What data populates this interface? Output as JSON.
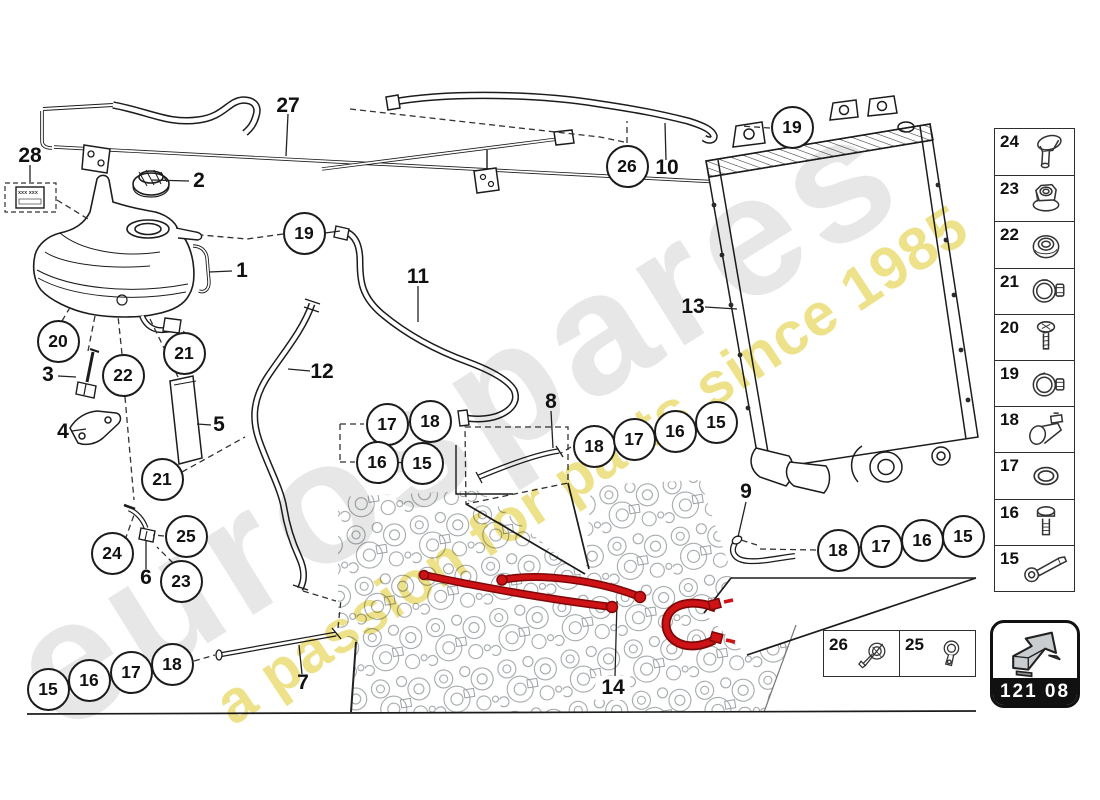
{
  "watermark": {
    "brand": "eurospares",
    "tagline": "a passion for parts since 1985",
    "brand_color": "#e7e7e7",
    "tagline_color": "#ece083"
  },
  "diagram": {
    "highlight_color": "#ce1216",
    "plate_text": "xxx xxx",
    "callouts": [
      {
        "label": "19",
        "x": 792,
        "y": 127
      },
      {
        "label": "26",
        "x": 627,
        "y": 166
      },
      {
        "label": "19",
        "x": 304,
        "y": 233
      },
      {
        "label": "20",
        "x": 58,
        "y": 341
      },
      {
        "label": "21",
        "x": 184,
        "y": 353
      },
      {
        "label": "22",
        "x": 123,
        "y": 375
      },
      {
        "label": "21",
        "x": 162,
        "y": 479
      },
      {
        "label": "17",
        "x": 387,
        "y": 424
      },
      {
        "label": "18",
        "x": 430,
        "y": 421
      },
      {
        "label": "16",
        "x": 377,
        "y": 462
      },
      {
        "label": "15",
        "x": 422,
        "y": 463
      },
      {
        "label": "18",
        "x": 594,
        "y": 446
      },
      {
        "label": "17",
        "x": 634,
        "y": 439
      },
      {
        "label": "16",
        "x": 675,
        "y": 431
      },
      {
        "label": "15",
        "x": 716,
        "y": 422
      },
      {
        "label": "18",
        "x": 838,
        "y": 550
      },
      {
        "label": "17",
        "x": 881,
        "y": 546
      },
      {
        "label": "16",
        "x": 922,
        "y": 540
      },
      {
        "label": "15",
        "x": 963,
        "y": 536
      },
      {
        "label": "24",
        "x": 112,
        "y": 553
      },
      {
        "label": "25",
        "x": 186,
        "y": 536
      },
      {
        "label": "23",
        "x": 181,
        "y": 581
      },
      {
        "label": "15",
        "x": 48,
        "y": 689
      },
      {
        "label": "16",
        "x": 89,
        "y": 680
      },
      {
        "label": "17",
        "x": 131,
        "y": 672
      },
      {
        "label": "18",
        "x": 172,
        "y": 664
      }
    ],
    "labels": [
      {
        "text": "27",
        "x": 288,
        "y": 106,
        "boxed": false
      },
      {
        "text": "28",
        "x": 30,
        "y": 156,
        "boxed": false
      },
      {
        "text": "2",
        "x": 199,
        "y": 181,
        "boxed": false
      },
      {
        "text": "1",
        "x": 242,
        "y": 271,
        "boxed": false
      },
      {
        "text": "10",
        "x": 667,
        "y": 168,
        "boxed": false
      },
      {
        "text": "11",
        "x": 418,
        "y": 277,
        "boxed": false
      },
      {
        "text": "13",
        "x": 693,
        "y": 307,
        "boxed": false
      },
      {
        "text": "3",
        "x": 48,
        "y": 375,
        "boxed": false
      },
      {
        "text": "4",
        "x": 63,
        "y": 432,
        "boxed": false
      },
      {
        "text": "5",
        "x": 219,
        "y": 425,
        "boxed": false
      },
      {
        "text": "12",
        "x": 322,
        "y": 372,
        "boxed": false
      },
      {
        "text": "8",
        "x": 551,
        "y": 402,
        "boxed": false
      },
      {
        "text": "9",
        "x": 746,
        "y": 492,
        "boxed": false
      },
      {
        "text": "6",
        "x": 146,
        "y": 578,
        "boxed": false
      },
      {
        "text": "7",
        "x": 303,
        "y": 683,
        "boxed": false
      },
      {
        "text": "14",
        "x": 613,
        "y": 688,
        "boxed": true
      }
    ]
  },
  "sidebar": {
    "items": [
      {
        "number": "24",
        "icon": "rivet-screw"
      },
      {
        "number": "23",
        "icon": "flange-nut"
      },
      {
        "number": "22",
        "icon": "grommet"
      },
      {
        "number": "21",
        "icon": "hose-clamp"
      },
      {
        "number": "20",
        "icon": "screw"
      },
      {
        "number": "19",
        "icon": "hose-clamp"
      },
      {
        "number": "18",
        "icon": "pipe-clip"
      },
      {
        "number": "17",
        "icon": "o-ring"
      },
      {
        "number": "16",
        "icon": "bolt"
      },
      {
        "number": "15",
        "icon": "hose-fitting"
      }
    ]
  },
  "legend": {
    "items": [
      {
        "number": "26",
        "icon": "spring-clamp"
      },
      {
        "number": "25",
        "icon": "band-clamp"
      }
    ]
  },
  "badge": {
    "code": "121 08"
  }
}
